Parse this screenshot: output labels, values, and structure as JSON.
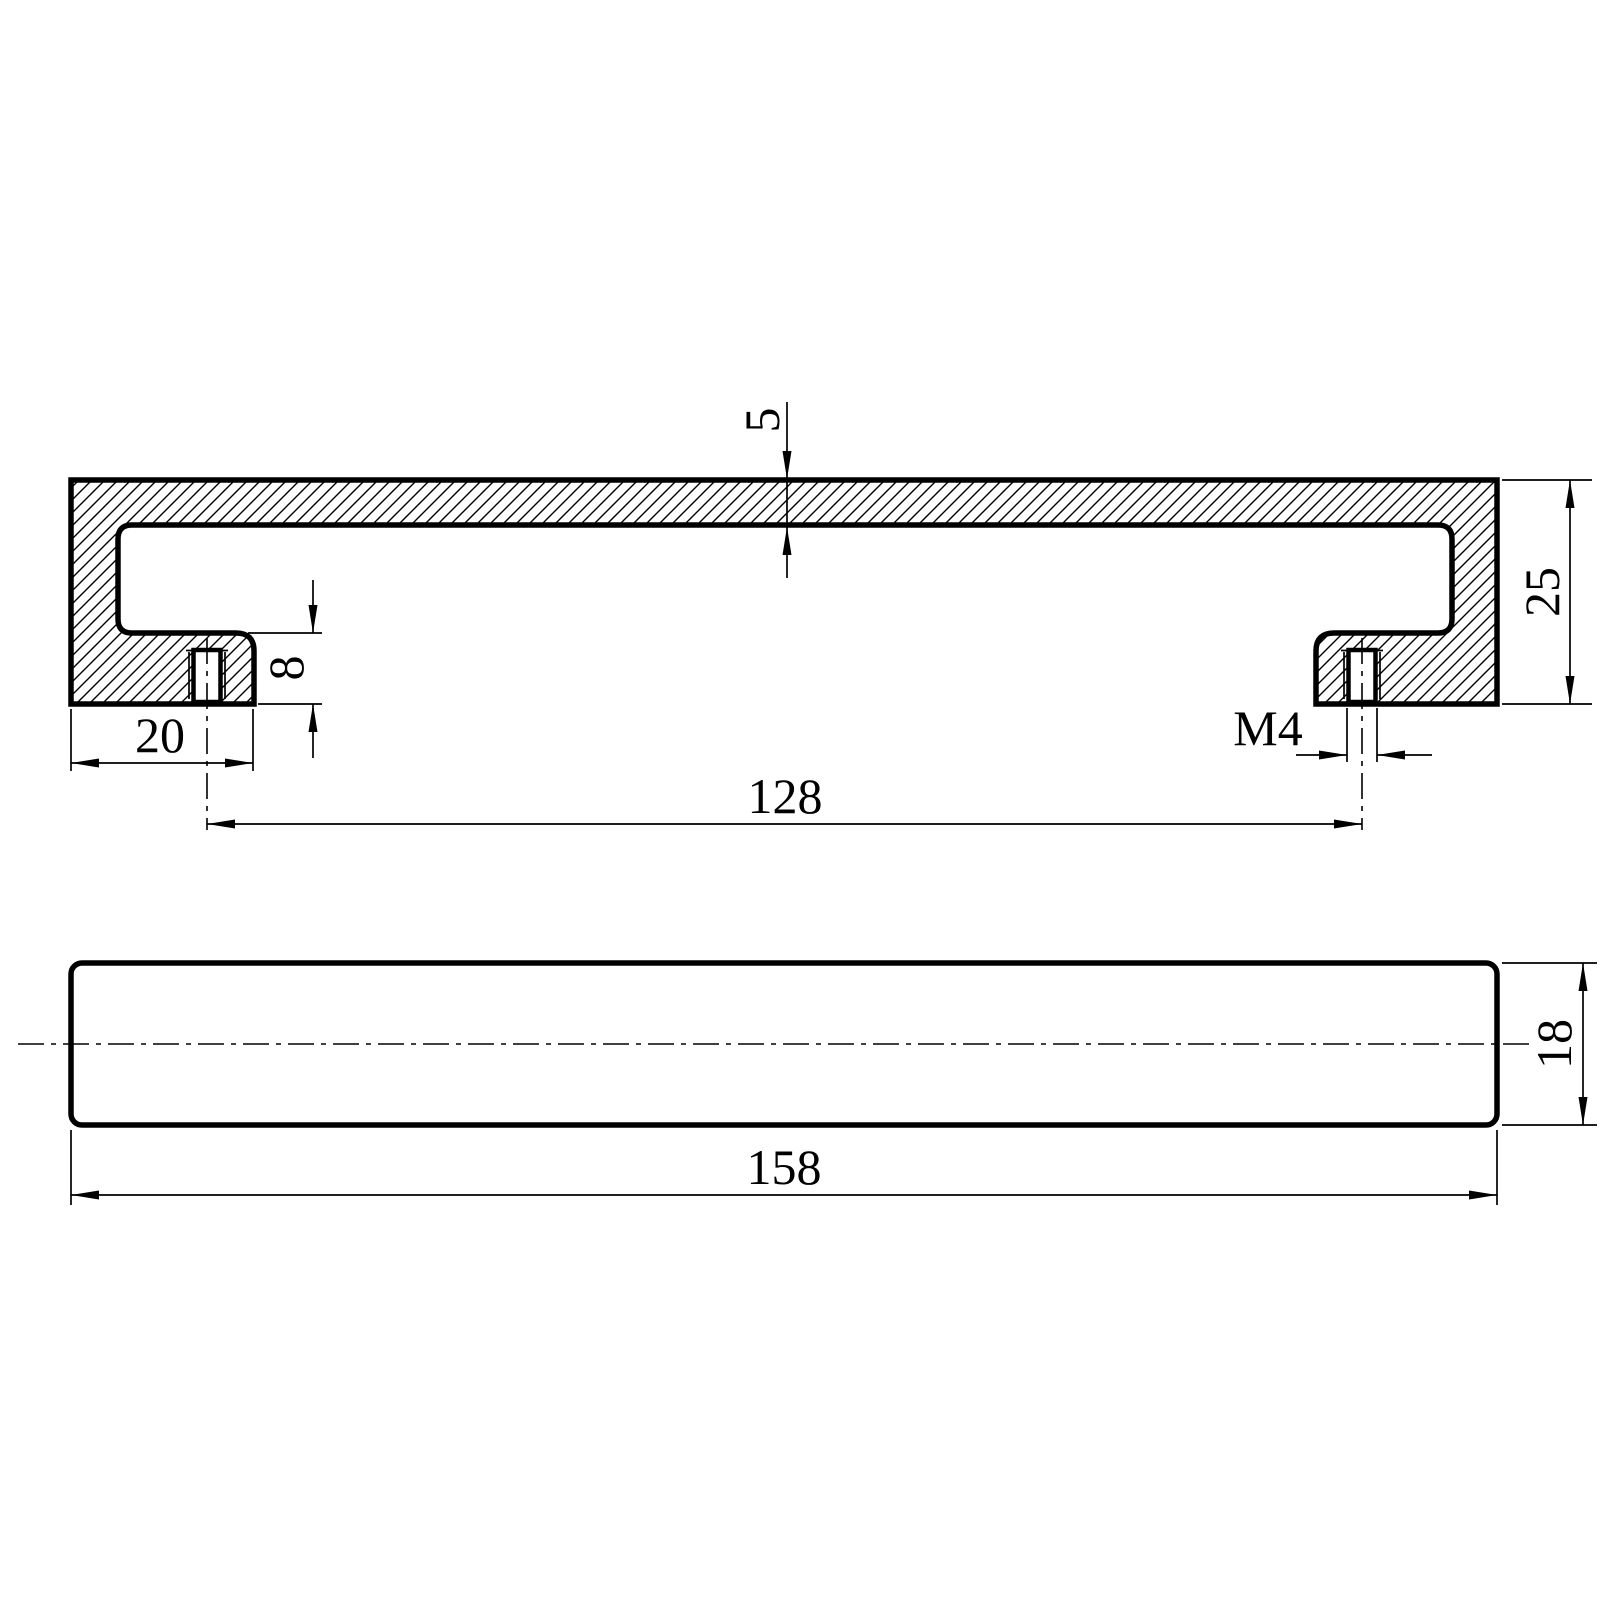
{
  "style": {
    "background_color": "#ffffff",
    "line_color": "#000000",
    "hatch_angle_deg": 45
  },
  "views": {
    "section": {
      "labels": {
        "top_plate_thickness": "5",
        "foot_step_height": "8",
        "foot_width": "20",
        "thread_size": "M4",
        "hole_center_distance": "128",
        "overall_height": "25"
      }
    },
    "plan": {
      "labels": {
        "overall_length": "158",
        "overall_width": "18"
      }
    }
  }
}
